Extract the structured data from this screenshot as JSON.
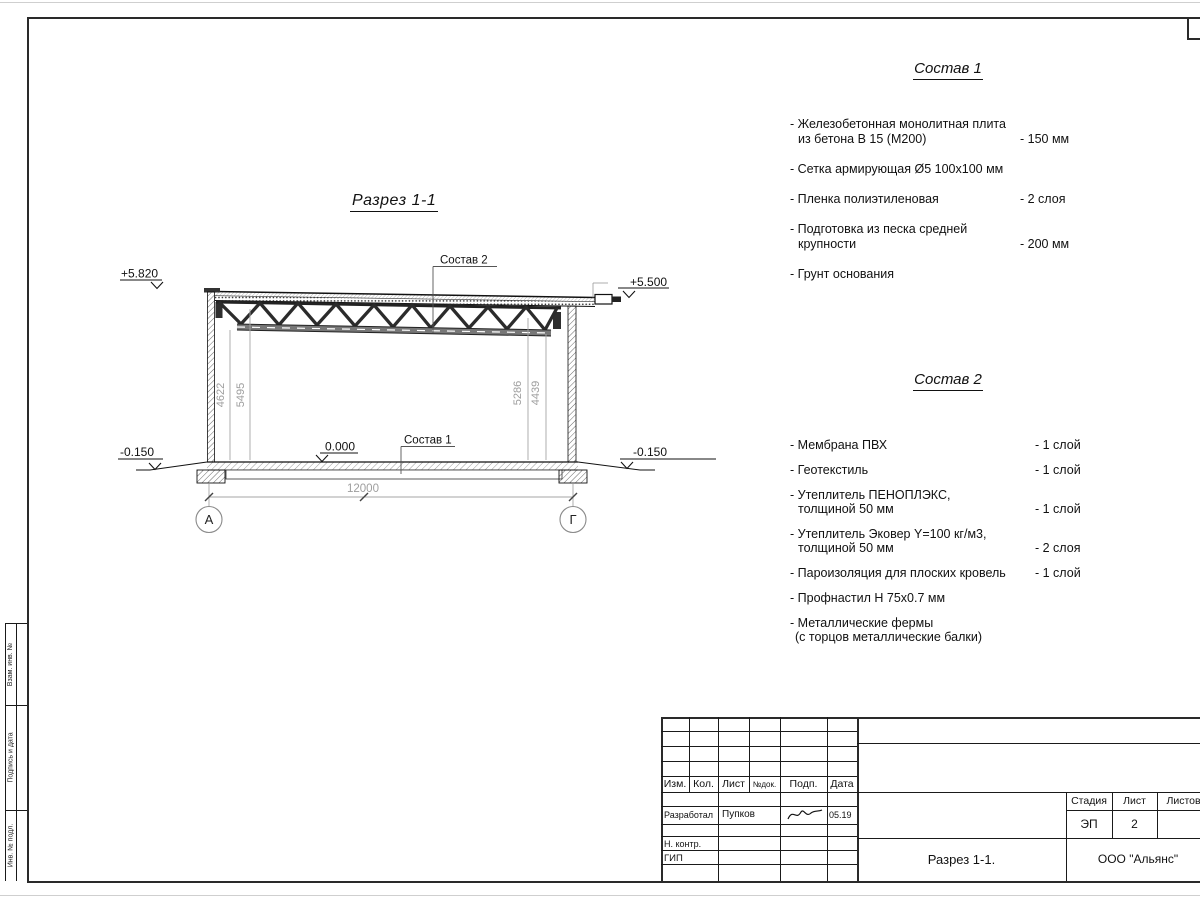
{
  "section": {
    "title": "Разрез 1-1",
    "elev_top_left": "+5.820",
    "elev_top_right": "+5.500",
    "elev_zero": "0.000",
    "elev_bottom_left": "-0.150",
    "elev_bottom_right": "-0.150",
    "ref_roof": "Состав 2",
    "ref_floor": "Состав 1",
    "dim_left_1": "4622",
    "dim_left_2": "5495",
    "dim_right_1": "5286",
    "dim_right_2": "4439",
    "dim_span": "12000",
    "axis_left": "А",
    "axis_right": "Г"
  },
  "sostav1": {
    "title": "Состав 1",
    "rows": [
      {
        "text": "- Железобетонная  монолитная плита"
      },
      {
        "text": "из бетона В 15 (М200)",
        "value": "- 150 мм"
      },
      {
        "text": "- Сетка армирующая Ø5 100х100 мм"
      },
      {
        "text": "- Пленка полиэтиленовая",
        "value": "-  2 слоя"
      },
      {
        "text": "- Подготовка из песка средней"
      },
      {
        "text": "крупности",
        "value": "- 200 мм"
      },
      {
        "text": "- Грунт основания"
      }
    ]
  },
  "sostav2": {
    "title": "Состав 2",
    "rows": [
      {
        "text": "- Мембрана ПВХ",
        "value": "- 1 слой"
      },
      {
        "text": "- Геотекстиль",
        "value": "- 1 слой"
      },
      {
        "text": "- Утеплитель ПЕНОПЛЭКС,"
      },
      {
        "text": "толщиной 50 мм",
        "value": "- 1 слой"
      },
      {
        "text": "- Утеплитель Эковер Y=100 кг/м3,"
      },
      {
        "text": "толщиной 50 мм",
        "value": "- 2 слоя"
      },
      {
        "text": "- Пароизоляция для плоских кровель",
        "value": "- 1 слой"
      },
      {
        "text": "- Профнастил Н 75х0.7 мм"
      },
      {
        "text": "- Металлические фермы"
      },
      {
        "text": "(с торцов металлические балки)"
      }
    ]
  },
  "titleblock": {
    "rev_cols": [
      "Изм.",
      "Кол.",
      "Лист",
      "№док.",
      "Подп.",
      "Дата"
    ],
    "role_developed": "Разработал",
    "name_developed": "Пупков",
    "date_developed": "05.19",
    "role_ncontrol": "Н. контр.",
    "role_gip": "ГИП",
    "stage_label": "Стадия",
    "sheet_label": "Лист",
    "sheets_label": "Листов",
    "stage_value": "ЭП",
    "sheet_value": "2",
    "doc_title": "Разрез 1-1.",
    "company": "ООО \"Альянс\""
  },
  "margin_labels": [
    "Взам. инв. №",
    "Подпись и дата",
    "Инв. № подл."
  ]
}
